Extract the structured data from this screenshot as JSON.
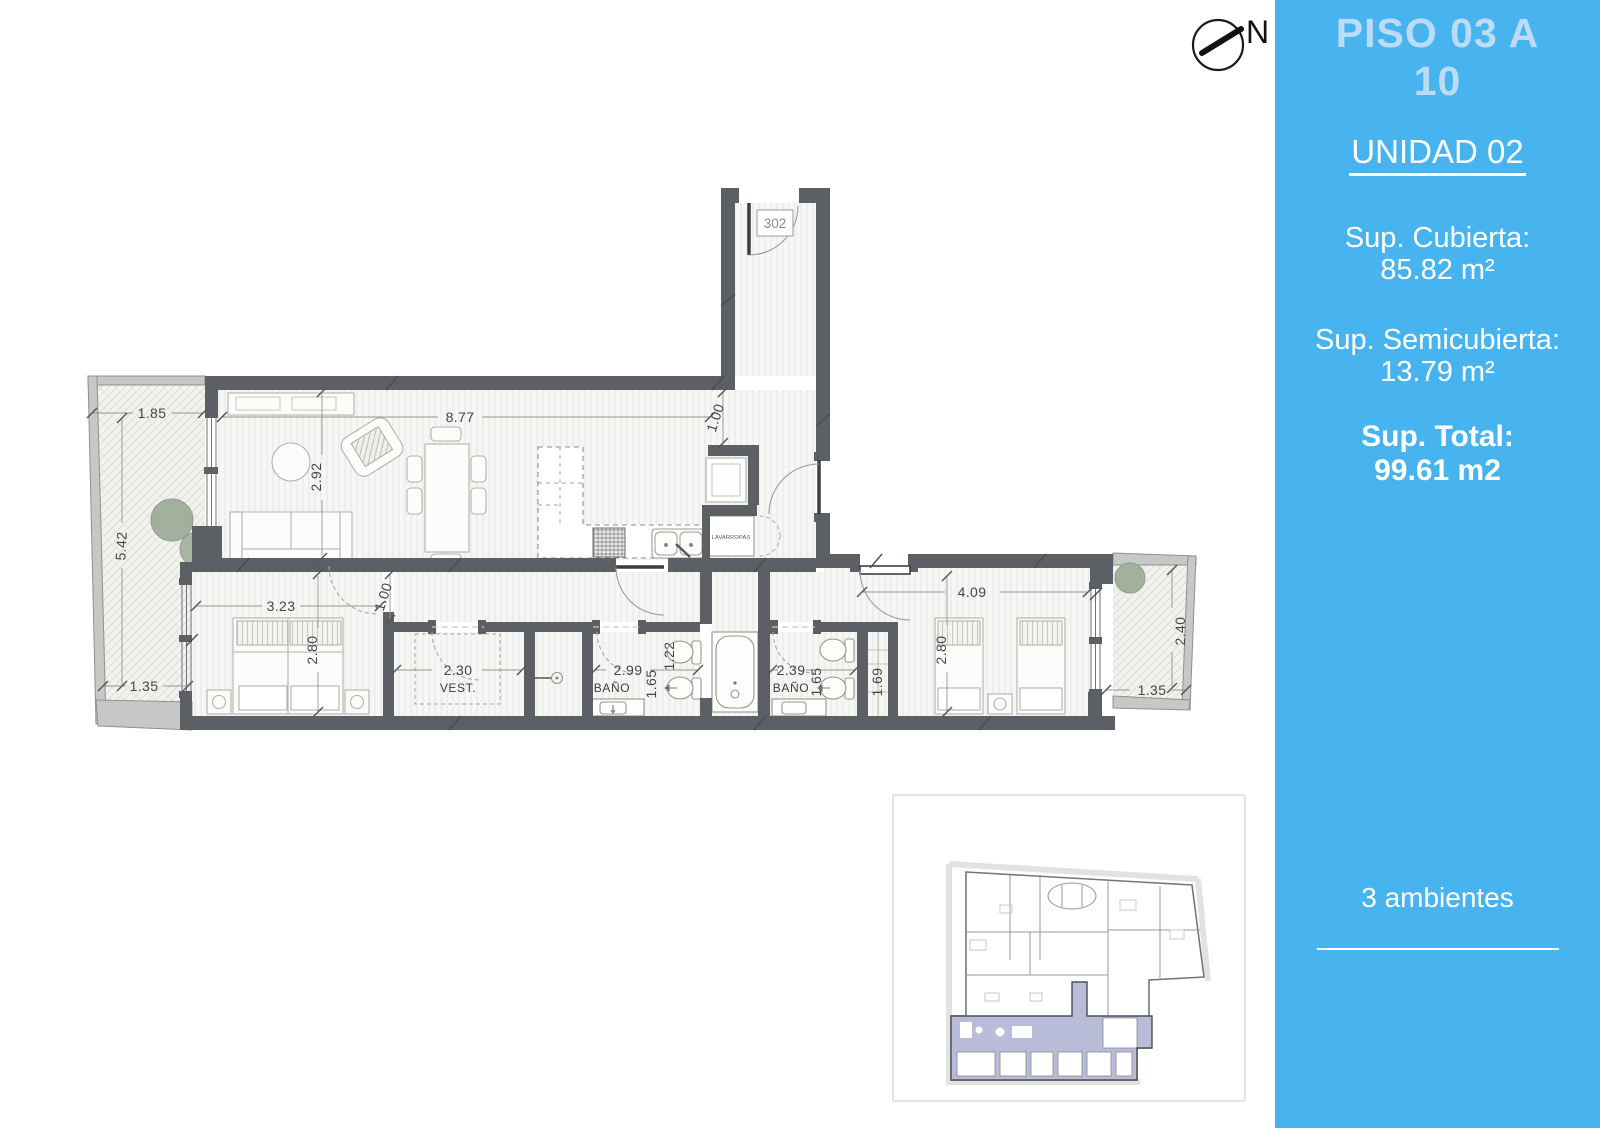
{
  "north_label": "N",
  "sidebar": {
    "accent_color": "#48b4ef",
    "title_color": "#badcf4",
    "title_line1": "PISO 03 A",
    "title_line2": "10",
    "unit": "UNIDAD 02",
    "covered_label": "Sup. Cubierta:",
    "covered_value": "85.82 m²",
    "semicovered_label": "Sup. Semicubierta:",
    "semicovered_value": "13.79 m²",
    "total_label": "Sup. Total:",
    "total_value": "99.61 m2",
    "rooms_count": "3 ambientes"
  },
  "plan": {
    "unit_number": "302",
    "rooms": {
      "vest": "VEST.",
      "bath1": "BAÑO",
      "bath2": "BAÑO",
      "laundry": "LAVARROPAS"
    },
    "dims": {
      "balcony_left_top": "1.85",
      "balcony_left_side": "5.42",
      "balcony_left_bottom": "1.35",
      "living_width": "8.77",
      "living_depth": "2.92",
      "kitchen_pass": "1.00",
      "bedroom1_width": "3.23",
      "bedroom1_depth": "2.80",
      "hall_width": "1.00",
      "vest_width": "2.30",
      "bath1_width": "2.99",
      "bath1_depth": "1.65",
      "tub_width": "1.22",
      "bath2_width": "2.39",
      "bath2_depth": "1.65",
      "closet2_depth": "1.69",
      "bedroom2_width": "4.09",
      "bedroom2_depth": "2.80",
      "balcony_right_side": "2.40",
      "balcony_right_bottom": "1.35"
    }
  }
}
